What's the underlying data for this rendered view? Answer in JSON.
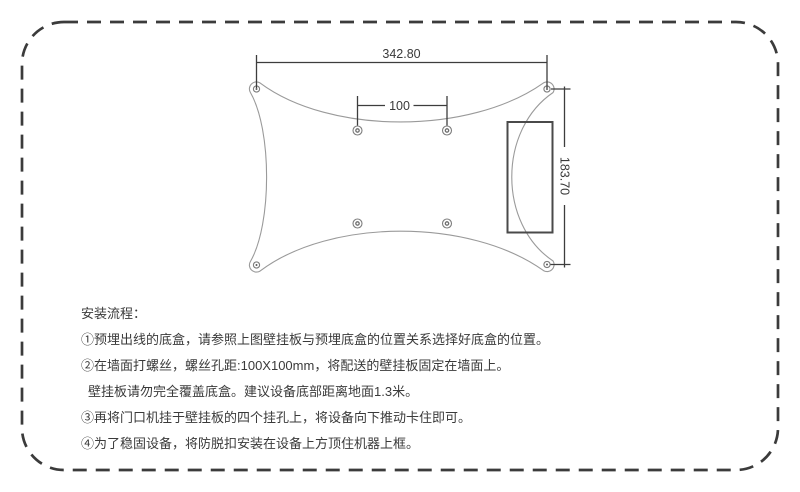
{
  "diagram": {
    "dimensions": {
      "width_mm": "342.80",
      "hole_spacing_mm": "100",
      "height_mm": "183.70"
    }
  },
  "instructions": {
    "title": "安装流程：",
    "steps": [
      "①预埋出线的底盒，请参照上图壁挂板与预埋底盒的位置关系选择好底盒的位置。",
      "②在墙面打螺丝，螺丝孔距:100X100mm，将配送的壁挂板固定在墙面上。",
      "壁挂板请勿完全覆盖底盒。建议设备底部距离地面1.3米。",
      "③再将门口机挂于壁挂板的四个挂孔上，将设备向下推动卡住即可。",
      "④为了稳固设备，将防脱扣安装在设备上方顶住机器上框。"
    ]
  },
  "colors": {
    "page_border": "#3b3b3b",
    "dimension_lines": "#3d3d3d",
    "plate_outline": "#9a9a9a",
    "body_text": "#3a3a3a"
  }
}
